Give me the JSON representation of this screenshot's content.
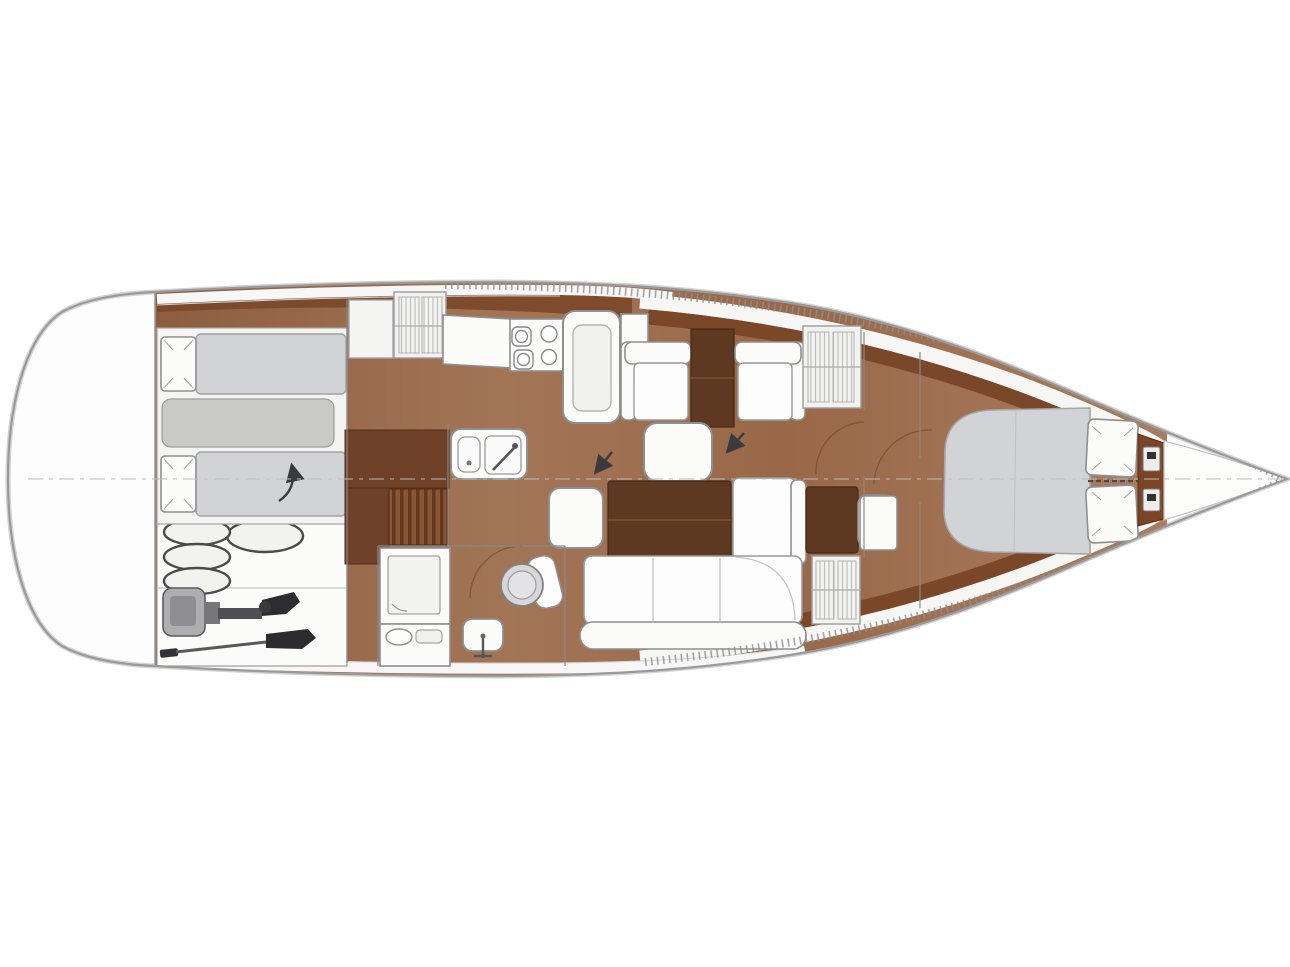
{
  "page": {
    "background": "#ffffff"
  },
  "diagram": {
    "kind": "sailing-yacht-interior-floorplan",
    "orientation": "top-down, bow pointing right",
    "areas": [
      {
        "name": "stern-platform",
        "items": [
          "rounded-transom"
        ]
      },
      {
        "name": "aft-cabin",
        "items": [
          "double-berth",
          "two-pillows",
          "backrest-infill",
          "direction-arrow"
        ]
      },
      {
        "name": "lazarette-storage",
        "items": [
          "three-stacked-fenders",
          "round-fender",
          "outboard-engine",
          "paddle"
        ]
      },
      {
        "name": "wardrobe-corridor",
        "items": [
          "dark-cabinets",
          "louvered-hanging-locker",
          "top-louvered-locker"
        ]
      },
      {
        "name": "galley",
        "items": [
          "counter",
          "four-burner-stove",
          "top-loading-fridge",
          "double-sink-with-faucet"
        ]
      },
      {
        "name": "aft-head",
        "items": [
          "shower-cabin",
          "toilet",
          "washbasin-with-tap",
          "vanity-basin"
        ]
      },
      {
        "name": "salon",
        "items": [
          "two-armchairs",
          "side-table",
          "coffee-table",
          "stool-seat",
          "folding-dining-table",
          "l-shaped-settee",
          "louvered-cabinet",
          "louvered-locker",
          "two-direction-arrows",
          "door-swing-arc"
        ]
      },
      {
        "name": "forward-owner-cabin",
        "items": [
          "island-double-berth",
          "two-pillows",
          "bedside-locker",
          "door-swing-arc"
        ]
      },
      {
        "name": "bow-anchor-locker",
        "items": [
          "bulkhead-fittings",
          "windlass-hardware"
        ]
      }
    ],
    "counts": {
      "stove_burners": 4,
      "fenders": 4,
      "aft_pillows": 2,
      "forward_pillows": 2,
      "settee_cushions": 3,
      "direction_arrows": 3
    }
  },
  "colors": {
    "hull-fill": "#fdfdfd",
    "hull-stroke": "#9a9a9a",
    "white": "#fbfbfa",
    "stroke": "#8f8f8f",
    "wood": "#9a6a4c",
    "wood-dark": "#7b4729",
    "wood-deep": "#5e3922",
    "mattress": "#d2d3d6",
    "mattress-dim": "#c9cac6",
    "dark": "#2e2e30",
    "metal": "#aeaeb1",
    "centerline": "#bdbdbd",
    "arrow": "#3b3b3d",
    "louver": "#bfbfbf"
  }
}
